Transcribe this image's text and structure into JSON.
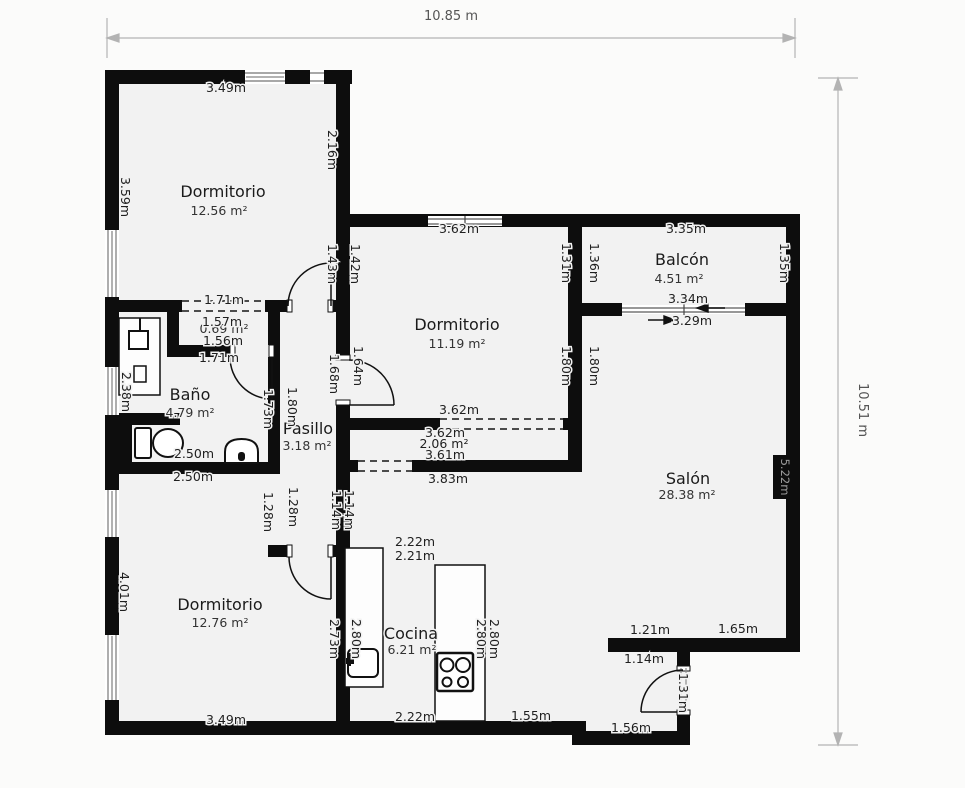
{
  "title": "Floor plan",
  "colors": {
    "wall": "#0d0d0d",
    "floor": "#f2f2f2",
    "background": "#fbfbfa",
    "label_text": "#1f1f1f",
    "dimension_line": "#b3b3b3",
    "dimension_text": "#555555",
    "badge_text": "#9c9c9c"
  },
  "overall_dimensions": {
    "width_label": "10.85 m",
    "height_label": "10.51 m"
  },
  "rooms": [
    {
      "id": "dorm1",
      "name": "Dormitorio",
      "area": "12.56 m²",
      "nx": 223,
      "ny": 197,
      "ax": 219,
      "ay": 215
    },
    {
      "id": "dorm2",
      "name": "Dormitorio",
      "area": "11.19 m²",
      "nx": 457,
      "ny": 330,
      "ax": 457,
      "ay": 348
    },
    {
      "id": "balcon",
      "name": "Balcón",
      "area": "4.51 m²",
      "nx": 682,
      "ny": 265,
      "ax": 679,
      "ay": 283
    },
    {
      "id": "bano",
      "name": "Baño",
      "area": "4.79 m²",
      "nx": 190,
      "ny": 400,
      "ax": 190,
      "ay": 417
    },
    {
      "id": "pasillo",
      "name": "Pasillo",
      "area": "3.18 m²",
      "nx": 308,
      "ny": 434,
      "ax": 307,
      "ay": 450
    },
    {
      "id": "salon",
      "name": "Salón",
      "area": "28.38 m²",
      "nx": 688,
      "ny": 484,
      "ax": 687,
      "ay": 499
    },
    {
      "id": "dorm3",
      "name": "Dormitorio",
      "area": "12.76 m²",
      "nx": 220,
      "ny": 610,
      "ax": 220,
      "ay": 627
    },
    {
      "id": "cocina",
      "name": "Cocina",
      "area": "6.21 m²",
      "nx": 411,
      "ny": 639,
      "ax": 412,
      "ay": 654
    },
    {
      "id": "closet",
      "name": "",
      "area": "0.69 m²",
      "nx": 224,
      "ny": 333,
      "ax": 224,
      "ay": 333
    }
  ],
  "measurements": [
    {
      "t": "3.49m",
      "x": 226,
      "y": 92,
      "r": 0
    },
    {
      "t": "2.16m",
      "x": 328,
      "y": 150,
      "r": 90
    },
    {
      "t": "3.59m",
      "x": 121,
      "y": 197,
      "r": 90
    },
    {
      "t": "1.71m",
      "x": 224,
      "y": 304,
      "r": 0
    },
    {
      "t": "1.57m",
      "x": 222,
      "y": 326,
      "r": 0
    },
    {
      "t": "1.56m",
      "x": 223,
      "y": 345,
      "r": 0
    },
    {
      "t": "1.71m",
      "x": 219,
      "y": 362,
      "r": 0
    },
    {
      "t": "1.43m",
      "x": 328,
      "y": 264,
      "r": 90
    },
    {
      "t": "1.42m",
      "x": 351,
      "y": 264,
      "r": 90
    },
    {
      "t": "3.62m",
      "x": 459,
      "y": 233,
      "r": 0
    },
    {
      "t": "1.31m",
      "x": 562,
      "y": 263,
      "r": 90
    },
    {
      "t": "1.36m",
      "x": 590,
      "y": 263,
      "r": 90
    },
    {
      "t": "3.35m",
      "x": 686,
      "y": 233,
      "r": 0
    },
    {
      "t": "1.35m",
      "x": 780,
      "y": 263,
      "r": 90
    },
    {
      "t": "3.34m",
      "x": 688,
      "y": 303,
      "r": 0
    },
    {
      "t": "3.29m",
      "x": 692,
      "y": 325,
      "r": 0
    },
    {
      "t": "1.68m",
      "x": 330,
      "y": 374,
      "r": 90
    },
    {
      "t": "1.64m",
      "x": 354,
      "y": 366,
      "r": 90
    },
    {
      "t": "1.80m",
      "x": 562,
      "y": 366,
      "r": 90
    },
    {
      "t": "1.80m",
      "x": 590,
      "y": 366,
      "r": 90
    },
    {
      "t": "2.38m",
      "x": 122,
      "y": 392,
      "r": 90
    },
    {
      "t": "1.73m",
      "x": 264,
      "y": 409,
      "r": 90
    },
    {
      "t": "1.80m",
      "x": 288,
      "y": 407,
      "r": 90
    },
    {
      "t": "3.62m",
      "x": 459,
      "y": 414,
      "r": 0
    },
    {
      "t": "3.62m",
      "x": 445,
      "y": 437,
      "r": 0
    },
    {
      "t": "2.06 m²",
      "x": 444,
      "y": 448,
      "r": 0
    },
    {
      "t": "3.61m",
      "x": 445,
      "y": 459,
      "r": 0
    },
    {
      "t": "3.83m",
      "x": 448,
      "y": 483,
      "r": 0
    },
    {
      "t": "2.50m",
      "x": 194,
      "y": 458,
      "r": 0
    },
    {
      "t": "2.50m",
      "x": 193,
      "y": 481,
      "r": 0
    },
    {
      "t": "1.28m",
      "x": 264,
      "y": 512,
      "r": 90
    },
    {
      "t": "1.28m",
      "x": 289,
      "y": 507,
      "r": 90
    },
    {
      "t": "1.14m",
      "x": 332,
      "y": 510,
      "r": 90
    },
    {
      "t": "1.14m",
      "x": 345,
      "y": 510,
      "r": 90
    },
    {
      "t": "2.22m",
      "x": 415,
      "y": 546,
      "r": 0
    },
    {
      "t": "2.21m",
      "x": 415,
      "y": 560,
      "r": 0
    },
    {
      "t": "4.01m",
      "x": 120,
      "y": 592,
      "r": 90
    },
    {
      "t": "2.73m",
      "x": 330,
      "y": 639,
      "r": 90
    },
    {
      "t": "2.80m",
      "x": 352,
      "y": 639,
      "r": 90
    },
    {
      "t": "2.80m",
      "x": 477,
      "y": 639,
      "r": 90
    },
    {
      "t": "2.80m",
      "x": 490,
      "y": 639,
      "r": 90
    },
    {
      "t": "1.21m",
      "x": 650,
      "y": 634,
      "r": 0
    },
    {
      "t": "1.65m",
      "x": 738,
      "y": 633,
      "r": 0
    },
    {
      "t": "1.14m",
      "x": 644,
      "y": 663,
      "r": 0
    },
    {
      "t": "1.31m",
      "x": 679,
      "y": 693,
      "r": 90
    },
    {
      "t": "3.49m",
      "x": 226,
      "y": 724,
      "r": 0
    },
    {
      "t": "2.22m",
      "x": 415,
      "y": 721,
      "r": 0
    },
    {
      "t": "1.55m",
      "x": 531,
      "y": 720,
      "r": 0
    },
    {
      "t": "1.56m",
      "x": 631,
      "y": 732,
      "r": 0
    }
  ],
  "wall_badge": {
    "t": "5.22m",
    "x": 781,
    "y": 477,
    "r": 90
  }
}
